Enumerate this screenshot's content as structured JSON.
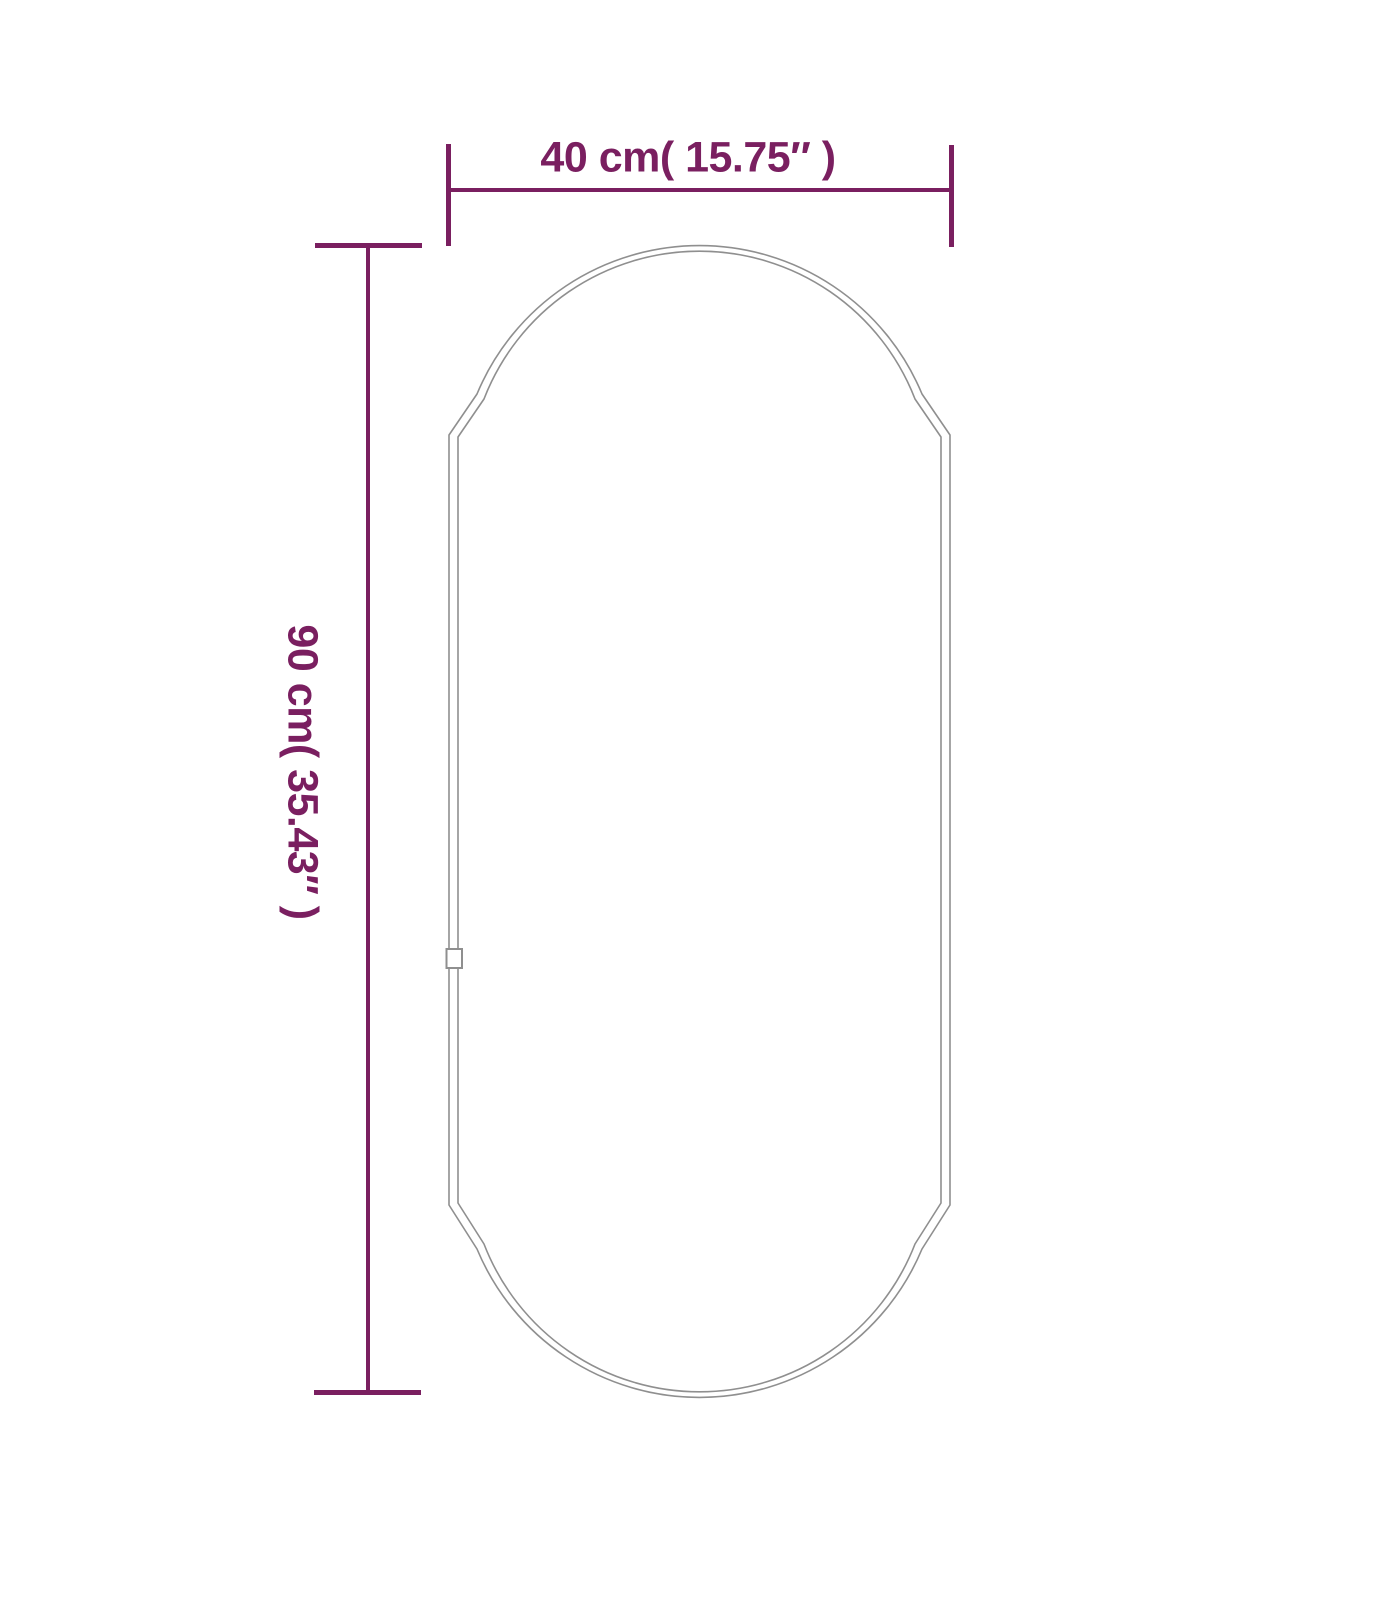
{
  "diagram": {
    "type": "product-dimension-diagram",
    "subject": "oval-pill-mirror-outline",
    "background_color": "#ffffff",
    "outline_color": "#8f8f8f",
    "dimension_color": "#7a1f60",
    "width_dimension": {
      "label": "40 cm( 15.75″ )",
      "cm": 40,
      "inches": 15.75
    },
    "height_dimension": {
      "label": "90 cm( 35.43″ )",
      "cm": 90,
      "inches": 35.43
    }
  }
}
